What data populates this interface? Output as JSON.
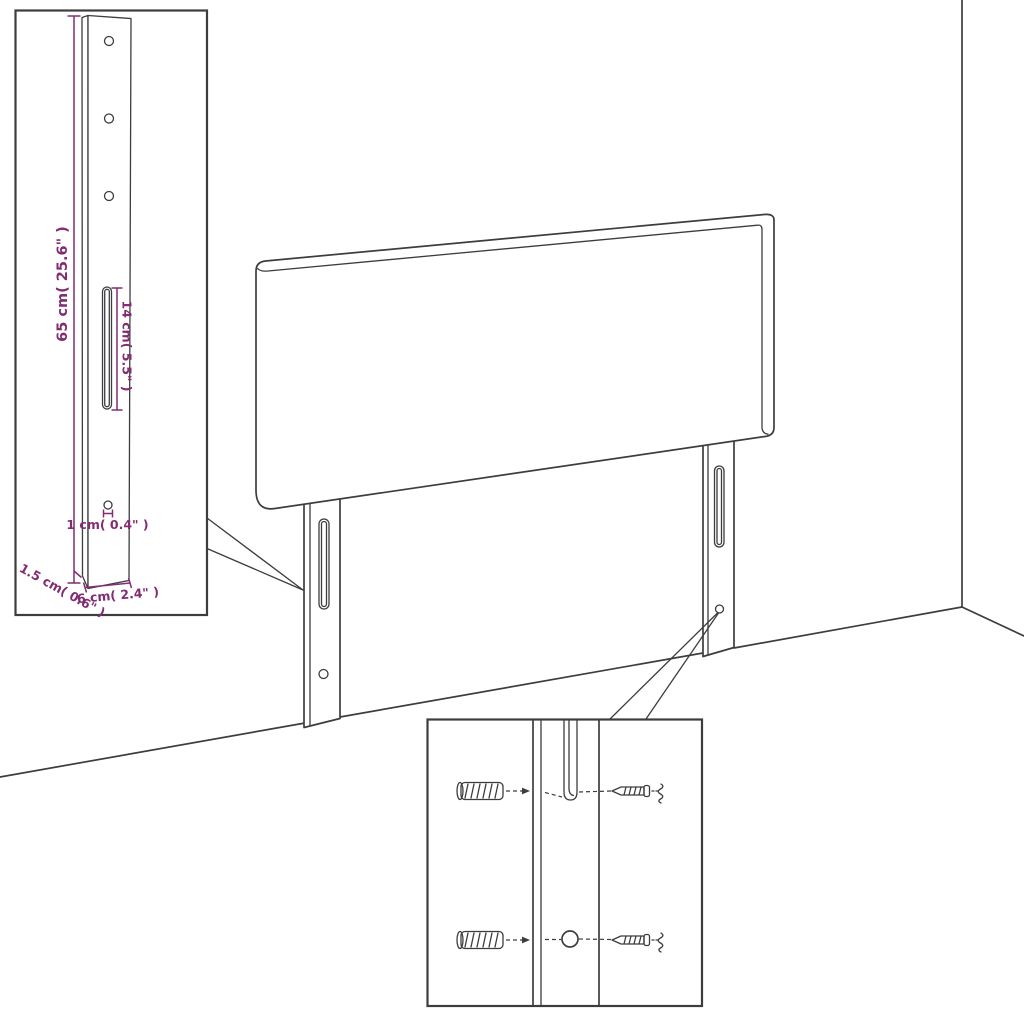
{
  "colors": {
    "background": "#ffffff",
    "line": "#3d3d40",
    "dimension": "#822d72"
  },
  "diagram": {
    "type": "assembly-dimension-diagram",
    "subject": "headboard with two mounting legs shown against a room corner",
    "inset_leg_detail": {
      "length_label": "65 cm( 25.6\" )",
      "slot_label": "14 cm( 5.5\" )",
      "hole_label": "1 cm( 0.4\" )",
      "thickness_label": "1.5 cm( 0.6\" )",
      "width_label": "6 cm( 2.4\" )"
    }
  }
}
